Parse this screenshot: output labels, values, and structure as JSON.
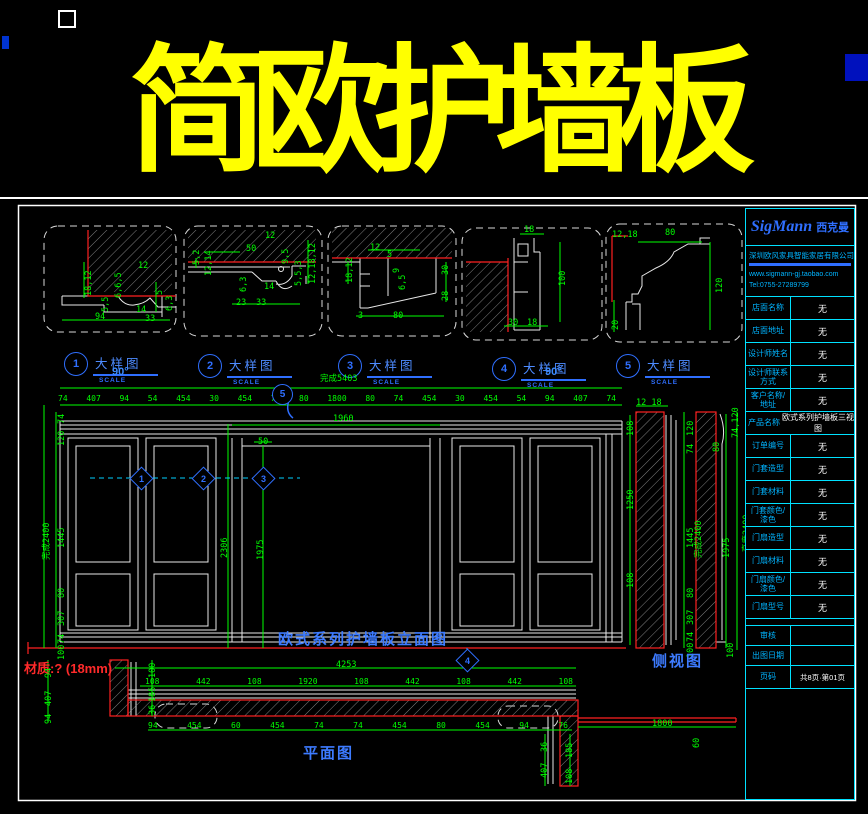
{
  "title": "简欧护墙板",
  "details": [
    {
      "num": "1",
      "label": "大样图",
      "scale_label": "SCALE",
      "dims": [
        "18,12",
        "12",
        "6,6,5",
        "5,5",
        "5",
        "6,3",
        "94",
        "14",
        "33"
      ]
    },
    {
      "num": "2",
      "label": "大样图",
      "scale_label": "SCALE",
      "dims": [
        "12",
        "50",
        "12,14",
        "5,2",
        "9,5",
        "5,5,3",
        "12,18,12",
        "6,3",
        "14",
        "23",
        "33"
      ]
    },
    {
      "num": "3",
      "label": "大样图",
      "scale_label": "SCALE",
      "dims": [
        "12",
        "18,12",
        "5",
        "9",
        "6,5",
        "30",
        "28",
        "3",
        "80"
      ]
    },
    {
      "num": "4",
      "label": "大样图",
      "scale_label": "SCALE",
      "dims": [
        "18",
        "100",
        "30",
        "18"
      ]
    },
    {
      "num": "5",
      "label": "大样图",
      "scale_label": "SCALE",
      "dims": [
        "12,18",
        "80",
        "120",
        "20"
      ]
    }
  ],
  "elevation": {
    "title": "欧式系列护墙板立面图",
    "overall_label": "完成5403",
    "angle_label": "90°",
    "top_dims": [
      "74",
      "407",
      "94",
      "54",
      "454",
      "30",
      "454",
      "74",
      "80",
      "1800",
      "80",
      "74",
      "454",
      "30",
      "454",
      "54",
      "94",
      "407",
      "74"
    ],
    "opening_dim": "1960",
    "left_dims": [
      "74",
      "120",
      "1445",
      "80",
      "307",
      "74",
      "100"
    ],
    "left_overall": "完成2400",
    "vert_dims": [
      "2306",
      "1975"
    ],
    "small_dim": "50",
    "callouts": {
      "c1": "1",
      "c2": "2",
      "c3": "3",
      "c4": "4",
      "c5": "5"
    }
  },
  "side_view": {
    "title": "侧视图",
    "top_dim": "12 18",
    "left_dims": [
      "108",
      "1250",
      "108"
    ],
    "mid_dims": [
      "120",
      "74",
      "1445",
      "80",
      "307",
      "74",
      "100"
    ],
    "mid_overall": "完成2400",
    "right_top_dim": "74,120",
    "right_dims": [
      "80",
      "1975",
      "100"
    ],
    "right_overall": "高度2400"
  },
  "plan": {
    "title": "平面图",
    "material_note": "材质:? (18mm)",
    "overall_dim": "4253",
    "upper_dims": [
      "108",
      "442",
      "108",
      "1920",
      "108",
      "442",
      "108",
      "442",
      "108"
    ],
    "left_dims": [
      "94",
      "407",
      "94"
    ],
    "corner_dims": [
      "100",
      "185",
      "36"
    ],
    "bottom_dims": [
      "94",
      "454",
      "60",
      "454",
      "74",
      "74",
      "454",
      "80",
      "454",
      "94",
      "76"
    ],
    "opening_dim": "1800",
    "opening_side_dim": "60",
    "leg_dims": [
      "36",
      "407",
      "185",
      "108"
    ]
  },
  "titleblock": {
    "brand_en": "SigMann",
    "brand_cn": "西克曼",
    "company": "深圳欧风家具智能家居有限公司",
    "website": "www.sigmann-gj.taobao.com",
    "tel": "Tel:0755-27289799",
    "rows": [
      {
        "label": "店面名称",
        "value": "无"
      },
      {
        "label": "店面地址",
        "value": "无"
      },
      {
        "label": "设计师姓名",
        "value": "无"
      },
      {
        "label": "设计师联系方式",
        "value": "无"
      },
      {
        "label": "客户名称/地址",
        "value": "无"
      },
      {
        "label": "产品名称",
        "value": "欧式系列护墙板三视图"
      },
      {
        "label": "订单编号",
        "value": "无"
      },
      {
        "label": "门套造型",
        "value": "无"
      },
      {
        "label": "门套材料",
        "value": "无"
      },
      {
        "label": "门套颜色/漆色",
        "value": "无"
      },
      {
        "label": "门扇造型",
        "value": "无"
      },
      {
        "label": "门扇材料",
        "value": "无"
      },
      {
        "label": "门扇颜色/漆色",
        "value": "无"
      },
      {
        "label": "门扇型号",
        "value": "无"
      },
      {
        "label": "审核",
        "value": ""
      },
      {
        "label": "出图日期",
        "value": ""
      },
      {
        "label": "页码",
        "value": "共8页·第01页"
      }
    ]
  },
  "colors": {
    "background": "#000000",
    "title_yellow": "#ffff00",
    "dim_green": "#00ff00",
    "line_white": "#ffffff",
    "accent_red": "#ff2020",
    "callout_blue": "#2f6fff",
    "table_cyan": "#00e1ff"
  }
}
